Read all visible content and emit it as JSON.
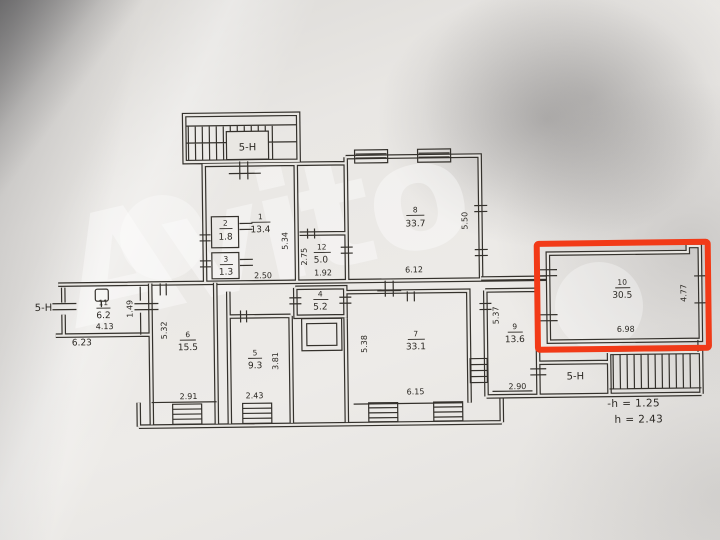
{
  "watermark": {
    "brand": "Avito"
  },
  "highlight": {
    "color": "#f23a17"
  },
  "labels": {
    "stair_top": "5-Н",
    "entry_left": "5-Н",
    "stair_bottom": "5-Н",
    "legend_line1": "-h = 1.25",
    "legend_line2": "h = 2.43"
  },
  "rooms": {
    "r1": {
      "num": "1",
      "area": "13.4"
    },
    "r2": {
      "num": "2",
      "area": "1.8"
    },
    "r3": {
      "num": "3",
      "area": "1.3"
    },
    "r4": {
      "num": "4",
      "area": "5.2"
    },
    "r5": {
      "num": "5",
      "area": "9.3"
    },
    "r6": {
      "num": "6",
      "area": "15.5"
    },
    "r7": {
      "num": "7",
      "area": "33.1"
    },
    "r8": {
      "num": "8",
      "area": "33.7"
    },
    "r9": {
      "num": "9",
      "area": "13.6"
    },
    "r10": {
      "num": "10",
      "area": "30.5"
    },
    "r11": {
      "num": "11",
      "area": "6.2"
    },
    "r12": {
      "num": "12",
      "area": "5.0"
    }
  },
  "dims": {
    "d_5_34": "5.34",
    "d_2_50": "2.50",
    "d_2_75": "2.75",
    "d_1_92": "1.92",
    "d_5_50": "5.50",
    "d_6_12": "6.12",
    "d_1_49": "1.49",
    "d_4_13": "4.13",
    "d_6_23": "6.23",
    "d_5_32": "5.32",
    "d_2_91": "2.91",
    "d_3_81": "3.81",
    "d_2_43": "2.43",
    "d_5_38": "5.38",
    "d_6_15": "6.15",
    "d_5_37": "5.37",
    "d_2_90": "2.90",
    "d_4_77": "4.77",
    "d_6_98": "6.98"
  }
}
